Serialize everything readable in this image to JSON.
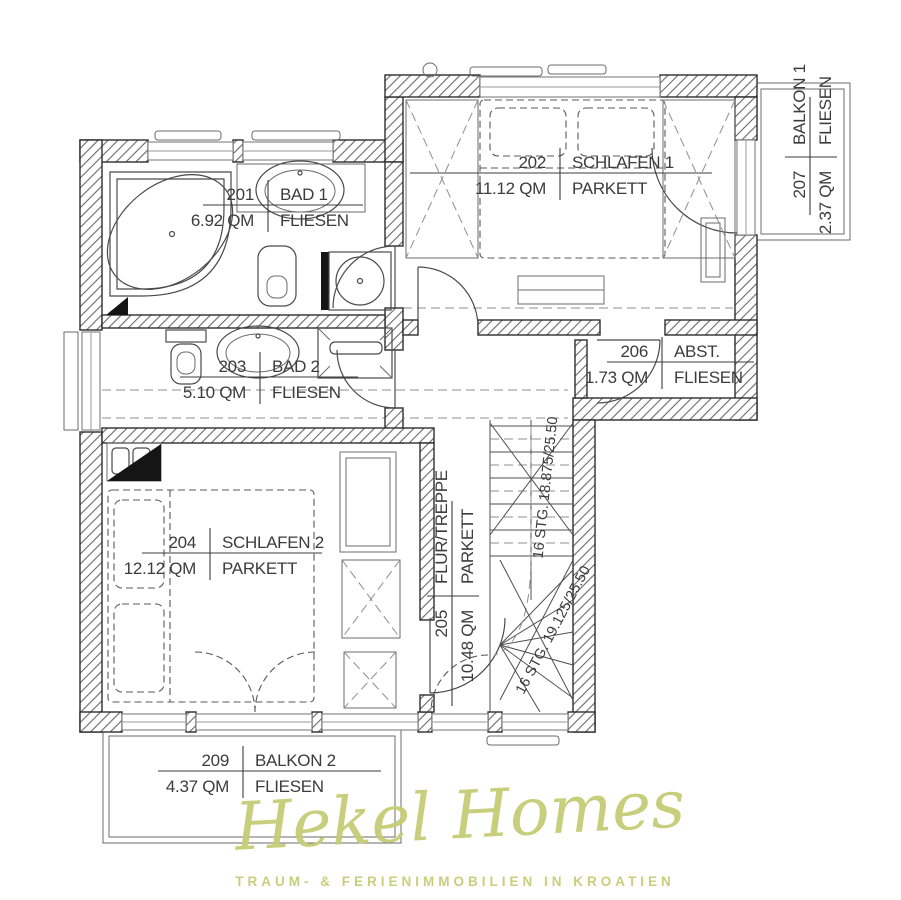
{
  "plan": {
    "rooms": {
      "r201": {
        "number": "201",
        "name": "BAD 1",
        "area": "6.92 QM",
        "floor": "FLIESEN"
      },
      "r202": {
        "number": "202",
        "name": "SCHLAFEN 1",
        "area": "11.12 QM",
        "floor": "PARKETT"
      },
      "r203": {
        "number": "203",
        "name": "BAD 2",
        "area": "5.10 QM",
        "floor": "FLIESEN"
      },
      "r204": {
        "number": "204",
        "name": "SCHLAFEN 2",
        "area": "12.12 QM",
        "floor": "PARKETT"
      },
      "r205": {
        "number": "205",
        "name": "FLUR/TREPPE",
        "area": "10.48 QM",
        "floor": "PARKETT"
      },
      "r206": {
        "number": "206",
        "name": "ABST.",
        "area": "1.73 QM",
        "floor": "FLIESEN"
      },
      "r207": {
        "number": "207",
        "name": "BALKON 1",
        "area": "2.37 QM",
        "floor": "FLIESEN"
      },
      "r209": {
        "number": "209",
        "name": "BALKON 2",
        "area": "4.37 QM",
        "floor": "FLIESEN"
      }
    },
    "stairs": {
      "upper_run": "16 STG. 18.875/25.50",
      "lower_run": "16 STG. 19.125/25.50"
    }
  },
  "watermark": {
    "brand": "Hekel Homes",
    "tagline": "TRAUM- & FERIENIMMOBILIEN IN KROATIEN",
    "color": "#c5cc75"
  }
}
